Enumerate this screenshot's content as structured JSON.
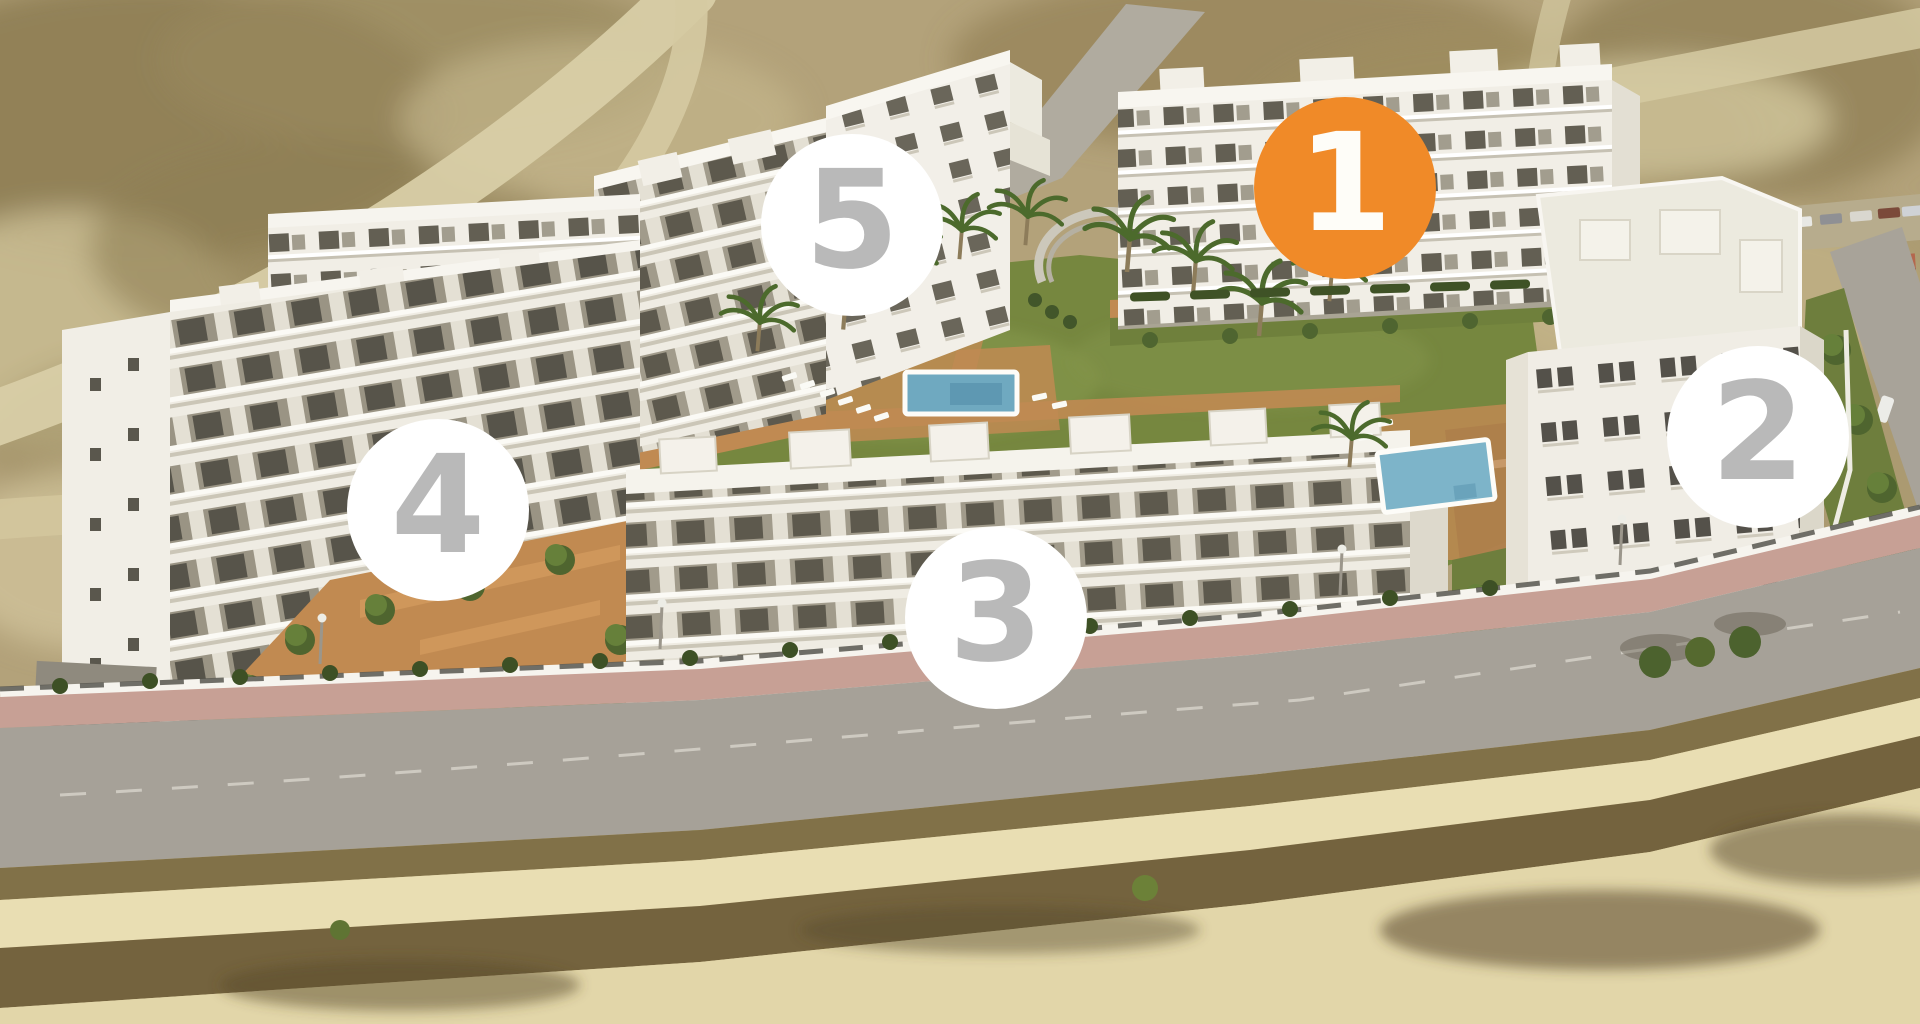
{
  "scene": {
    "type": "aerial-residential-development-site-plan",
    "marker_diameter_px": 182,
    "marker_font_px": 136,
    "colors": {
      "marker_selected_bg": "#F08A28",
      "marker_selected_text": "#FEFDF8",
      "marker_bg": "#FFFFFF",
      "marker_text": "#B9B9B9"
    },
    "markers": [
      {
        "label": "1",
        "selected": true,
        "cx": 1345,
        "cy": 188
      },
      {
        "label": "2",
        "selected": false,
        "cx": 1758,
        "cy": 437
      },
      {
        "label": "3",
        "selected": false,
        "cx": 996,
        "cy": 618
      },
      {
        "label": "4",
        "selected": false,
        "cx": 438,
        "cy": 510
      },
      {
        "label": "5",
        "selected": false,
        "cx": 852,
        "cy": 225
      }
    ]
  }
}
